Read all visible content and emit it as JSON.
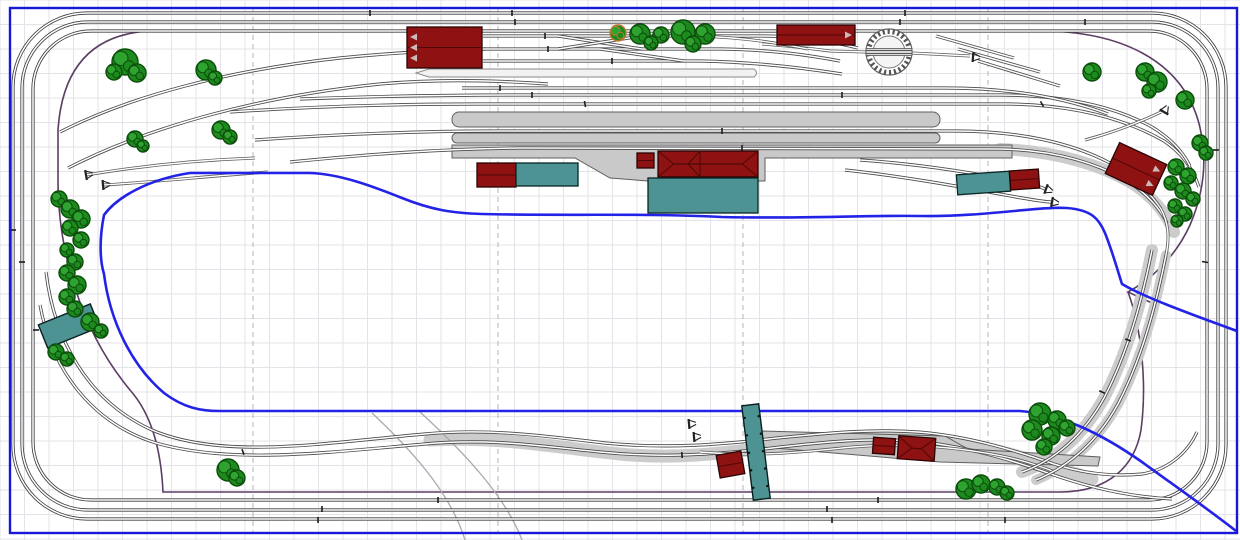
{
  "canvas": {
    "w": 1240,
    "h": 540,
    "bg": "#ffffff"
  },
  "grid": {
    "spacing": 24.5,
    "color": "#e3e3e9",
    "joint_xs": [
      253,
      498,
      743,
      988
    ],
    "joint_color": "#b3b3bc"
  },
  "board": {
    "x": 10,
    "y": 8,
    "w": 1227,
    "h": 525,
    "color": "#1717d8",
    "width": 2.4
  },
  "colors": {
    "ballast": "#cccccc",
    "platform_fill": "#c9c9c9",
    "platform_edge": "#5f5f5f",
    "building_red": "#8e1212",
    "building_red_edge": "#2a0404",
    "roof_line": "#4e0808",
    "building_teal": "#4e9393",
    "building_teal_edge": "#082626",
    "tree_fill": "#1d8a1d",
    "tree_edge": "#0c4d0c",
    "tree_highlight": "#2fa32f",
    "tree_autumn_edge": "#c07830",
    "river": "#2323e8",
    "hidden_line": "#5b3d63",
    "road": "#aaaaaa",
    "arrow_fill": "#cdb8b8",
    "tick": "#1b1b1b",
    "buffer": "#222222"
  },
  "styles": {
    "loop": [
      "#3e3e3e",
      3.2,
      "#ffffff",
      1.5
    ],
    "dark": [
      "#4a4a4a",
      3.2,
      "#ffffff",
      1.5
    ],
    "mid": [
      "#5a5a5a",
      3.0,
      "#ffffff",
      1.4
    ],
    "light": [
      "#8c8c8c",
      2.8,
      "#ffffff",
      1.3
    ]
  },
  "loops": [
    {
      "id": "outer-main-loop",
      "rect": [
        13,
        13,
        1213,
        506,
        74
      ]
    },
    {
      "id": "second-main-loop",
      "rect": [
        22,
        22,
        1196,
        488,
        66
      ]
    },
    {
      "id": "third-loop",
      "rect": [
        33,
        31,
        1174,
        469,
        58
      ]
    }
  ],
  "hidden_line": {
    "id": "hidden-track-loop",
    "d": "M 150,31 L 1040,31 C 1120,31 1180,60 1198,120 C 1208,155 1205,190 1190,225 C 1175,258 1150,280 1128,292 L 1152,303 M 150,31 C 90,34 62,70 58,130 L 58,180 C 58,250 80,330 130,390 C 152,415 161,450 163,492 L 1060,492 C 1110,492 1135,465 1141,430 C 1147,385 1142,330 1128,292",
    "width": 1.6
  },
  "ballast": [
    {
      "d": "M 430,440 C 500,436 560,448 620,454 C 680,460 730,452 790,445 C 850,438 890,436 940,440 C 990,446 1042,463 1092,479",
      "w": 13
    },
    {
      "d": "M 1152,250 C 1142,300 1128,352 1104,398 C 1084,434 1056,460 1022,472",
      "w": 12
    },
    {
      "d": "M 1166,255 C 1156,305 1142,358 1118,404 C 1098,440 1070,466 1036,480",
      "w": 10
    },
    {
      "d": "M 1000,149 C 1052,151 1096,163 1130,182 C 1152,196 1166,212 1174,232",
      "w": 12
    }
  ],
  "tracks": [
    {
      "id": "lead-west-upper",
      "style": "dark",
      "d": "M 60,132 C 130,96 230,70 340,58 C 390,53 440,50 486,49"
    },
    {
      "id": "lead-west-mid",
      "style": "dark",
      "d": "M 68,168 C 150,126 262,96 380,84 C 434,79 492,80 548,84"
    },
    {
      "id": "approach-west-1",
      "style": "dark",
      "d": "M 230,112 C 320,106 400,104 480,104 L 1010,104 C 1070,105 1122,117 1164,141 C 1182,153 1193,169 1199,187"
    },
    {
      "id": "approach-west-2",
      "style": "dark",
      "d": "M 300,99 C 380,96 452,95 520,95 L 1000,95 C 1060,95 1112,105 1152,127 C 1170,138 1183,152 1190,166"
    },
    {
      "id": "yard-low",
      "style": "dark",
      "d": "M 462,88 L 945,88 C 1010,88 1062,97 1108,114"
    },
    {
      "id": "station-track-s1",
      "style": "dark",
      "d": "M 255,140 C 340,134 420,131 500,131 L 955,131 C 1020,131 1072,143 1110,163 C 1132,175 1149,191 1161,209"
    },
    {
      "id": "station-track-s2",
      "style": "dark",
      "d": "M 290,162 C 370,154 440,149 520,148 L 1000,149 C 1050,150 1092,161 1126,180 C 1146,193 1159,207 1167,223"
    },
    {
      "id": "goods-siding-1",
      "style": "dark",
      "d": "M 860,160 C 920,164 980,174 1020,182 C 1034,185 1041,187 1045,189"
    },
    {
      "id": "goods-siding-2",
      "style": "dark",
      "d": "M 845,170 C 910,177 972,189 1016,197 C 1034,200 1045,202 1051,202"
    },
    {
      "id": "stub-siding-1",
      "style": "mid",
      "d": "M 255,158 C 200,160 140,166 86,175"
    },
    {
      "id": "stub-siding-2",
      "style": "mid",
      "d": "M 268,172 C 210,176 155,182 103,185"
    },
    {
      "id": "shed-track-1",
      "style": "dark",
      "d": "M 483,36 L 758,36 C 802,36 830,41 858,48"
    },
    {
      "id": "shed-track-2",
      "style": "dark",
      "d": "M 483,49 L 722,49 C 774,50 808,55 840,61"
    },
    {
      "id": "shed-track-3",
      "style": "dark",
      "d": "M 483,61 L 700,61 C 754,62 798,67 842,74"
    },
    {
      "id": "turntable-feed-west",
      "style": "mid",
      "d": "M 762,44 C 792,46 814,49 830,51 L 866,52"
    },
    {
      "id": "turntable-feed-east",
      "style": "mid",
      "d": "M 912,53 L 970,56"
    },
    {
      "id": "crossover-1a",
      "style": "dark",
      "d": "M 558,36 L 642,49"
    },
    {
      "id": "crossover-1b",
      "style": "dark",
      "d": "M 642,36 L 558,49"
    },
    {
      "id": "crossover-2",
      "style": "dark",
      "d": "M 600,49 L 684,61"
    },
    {
      "id": "ladder-1",
      "style": "dark",
      "d": "M 936,36 L 1014,58"
    },
    {
      "id": "ladder-2",
      "style": "dark",
      "d": "M 958,49 L 1040,72"
    },
    {
      "id": "ladder-3",
      "style": "dark",
      "d": "M 978,61 L 1060,86"
    },
    {
      "id": "top-link",
      "style": "mid",
      "d": "M 700,36 C 748,38 778,43 808,49"
    },
    {
      "id": "branch-south-a",
      "style": "dark",
      "d": "M 40,305 C 52,372 94,424 156,443 C 232,465 330,452 425,444 C 490,438 540,446 600,452 C 660,458 712,455 772,448 C 832,441 868,438 912,441 C 962,445 1008,459 1048,473 C 1090,488 1132,497 1172,499"
    },
    {
      "id": "branch-south-b",
      "style": "dark",
      "d": "M 46,272 C 54,338 86,400 152,430 C 224,461 330,442 425,434 C 490,428 545,436 605,443 C 665,449 717,445 777,438 C 837,432 874,429 918,432 C 968,436 1014,450 1054,464 C 1082,473 1112,477 1142,474 C 1167,470 1187,454 1197,432"
    },
    {
      "id": "goods-loop",
      "style": "mid",
      "d": "M 700,452 C 762,457 802,452 852,447 C 902,443 952,446 1002,456 C 1022,460 1040,466 1055,472"
    },
    {
      "id": "diagonal-1",
      "style": "dark",
      "d": "M 1152,250 C 1142,300 1128,352 1104,398 C 1084,434 1056,460 1022,472"
    },
    {
      "id": "diagonal-2",
      "style": "dark",
      "d": "M 1166,255 C 1156,305 1142,358 1118,404 C 1098,440 1070,466 1036,480"
    },
    {
      "id": "se-curve-link",
      "style": "mid",
      "d": "M 1161,209 C 1168,222 1170,236 1166,255"
    },
    {
      "id": "ne-stub",
      "style": "mid",
      "d": "M 1085,140 C 1115,132 1140,122 1161,112"
    }
  ],
  "river": {
    "id": "river",
    "d": "M 190,173 L 310,173 C 340,174 372,186 402,198 C 432,210 452,213 482,214 C 562,216 642,213 722,217 C 802,219 862,215 922,216 C 982,217 1042,206 1067,208 C 1092,210 1099,219 1105,233 C 1113,253 1118,272 1122,284 C 1142,296 1182,311 1237,331 M 190,173 C 150,179 118,196 104,215 C 99,240 100,261 104,274 C 110,322 132,366 164,393 C 184,408 201,411 219,411 L 1020,411 C 1062,414 1102,434 1142,462 C 1182,491 1212,512 1236,531",
    "width": 2.6
  },
  "roads": [
    {
      "id": "road-1",
      "d": "M 372,413 C 420,458 452,498 465,540"
    },
    {
      "id": "road-2",
      "d": "M 420,412 C 468,456 506,498 522,540"
    }
  ],
  "platforms": [
    {
      "id": "platform-1",
      "x": 452,
      "y": 112,
      "w": 488,
      "h": 15,
      "rx": 7
    },
    {
      "id": "platform-2",
      "x": 452,
      "y": 133,
      "w": 488,
      "h": 10,
      "rx": 5
    }
  ],
  "aprons": [
    {
      "id": "station-forecourt",
      "points": "452,145 1012,145 1012,158 765,158 765,181 648,181 610,178 575,158 452,158"
    },
    {
      "id": "goods-platform",
      "points": "762,431 945,436 968,449 1100,457 1098,466 940,462 762,447"
    }
  ],
  "arrow_track": {
    "id": "uncoupler-track",
    "d": "M 429,69 L 754,69 Q 759,73 754,77 L 429,77 L 416,73 Z"
  },
  "turntable": {
    "id": "turntable",
    "cx": 889,
    "cy": 52,
    "r": 23
  },
  "buildings": [
    {
      "id": "engine-shed",
      "x": 407,
      "y": 27,
      "w": 75,
      "h": 41,
      "rot": 0,
      "color": "red",
      "roof": "midline",
      "arrows": {
        "side": "left",
        "ys": [
          10,
          20.5,
          31
        ]
      }
    },
    {
      "id": "depot-shed",
      "x": 777,
      "y": 25,
      "w": 78,
      "h": 20,
      "rot": 0,
      "color": "red",
      "roof": "midline",
      "arrows": {
        "side": "right",
        "ys": [
          10
        ]
      }
    },
    {
      "id": "station-annex-red",
      "x": 477,
      "y": 163,
      "w": 39,
      "h": 24,
      "rot": 0,
      "color": "red",
      "roof": "midline"
    },
    {
      "id": "station-annex-teal",
      "x": 516,
      "y": 163,
      "w": 62,
      "h": 23,
      "rot": 0,
      "color": "teal",
      "roof": "flat"
    },
    {
      "id": "small-shed",
      "x": 637,
      "y": 153,
      "w": 17,
      "h": 15,
      "rot": 0,
      "color": "red",
      "roof": "midline"
    },
    {
      "id": "station-main",
      "x": 658,
      "y": 151,
      "w": 100,
      "h": 26,
      "rot": 0,
      "color": "red",
      "roof": "hip2"
    },
    {
      "id": "station-hall",
      "x": 648,
      "y": 178,
      "w": 110,
      "h": 35,
      "rot": 0,
      "color": "teal",
      "roof": "flat"
    },
    {
      "id": "goods-shed-teal",
      "x": 957,
      "y": 173,
      "w": 53,
      "h": 20,
      "rot": -4,
      "color": "teal",
      "roof": "flat"
    },
    {
      "id": "goods-shed-red",
      "x": 1010,
      "y": 170,
      "w": 29,
      "h": 19,
      "rot": -4,
      "color": "red",
      "roof": "midline"
    },
    {
      "id": "warehouse-ne",
      "x": 1110,
      "y": 152,
      "w": 52,
      "h": 34,
      "rot": 25,
      "color": "red",
      "roof": "midline",
      "arrows": {
        "side": "right",
        "ys": [
          9,
          25
        ]
      }
    },
    {
      "id": "lineside-hut",
      "x": 718,
      "y": 453,
      "w": 25,
      "h": 23,
      "rot": -10,
      "color": "red",
      "roof": "midline"
    },
    {
      "id": "goods-hut-small",
      "x": 873,
      "y": 438,
      "w": 22,
      "h": 16,
      "rot": 4,
      "color": "red",
      "roof": "midline"
    },
    {
      "id": "goods-hut-big",
      "x": 898,
      "y": 437,
      "w": 37,
      "h": 23,
      "rot": 4,
      "color": "red",
      "roof": "hip"
    }
  ],
  "bridges": [
    {
      "id": "river-bridge",
      "cx": 69,
      "cy": 326,
      "w": 56,
      "h": 25,
      "rot": -22,
      "dots": false
    },
    {
      "id": "road-bridge",
      "cx": 756,
      "cy": 452,
      "w": 17,
      "h": 95,
      "rot": -7,
      "dots": true
    }
  ],
  "buffers": [
    [
      86,
      175,
      -10
    ],
    [
      103,
      185,
      -5
    ],
    [
      1046,
      189,
      20
    ],
    [
      1052,
      202,
      10
    ],
    [
      1164,
      112,
      -60
    ],
    [
      973,
      57,
      5
    ],
    [
      689,
      424,
      -5
    ],
    [
      694,
      437,
      -5
    ]
  ],
  "ticks": [
    [
      370,
      13,
      90
    ],
    [
      512,
      13,
      90
    ],
    [
      905,
      13,
      90
    ],
    [
      515,
      22,
      90
    ],
    [
      900,
      22,
      90
    ],
    [
      1085,
      22,
      90
    ],
    [
      545,
      36,
      90
    ],
    [
      548,
      49,
      90
    ],
    [
      612,
      61,
      90
    ],
    [
      500,
      88,
      90
    ],
    [
      532,
      95,
      90
    ],
    [
      585,
      104,
      80
    ],
    [
      722,
      131,
      90
    ],
    [
      742,
      148,
      90
    ],
    [
      842,
      95,
      90
    ],
    [
      1042,
      104,
      60
    ],
    [
      13,
      230,
      0
    ],
    [
      22,
      262,
      0
    ],
    [
      36,
      330,
      0
    ],
    [
      318,
      520,
      90
    ],
    [
      322,
      509,
      90
    ],
    [
      438,
      500,
      90
    ],
    [
      832,
      520,
      90
    ],
    [
      827,
      509,
      90
    ],
    [
      878,
      500,
      90
    ],
    [
      1005,
      520,
      90
    ],
    [
      243,
      452,
      70
    ],
    [
      682,
      455,
      85
    ],
    [
      908,
      439,
      85
    ],
    [
      1128,
      340,
      20
    ],
    [
      1102,
      392,
      25
    ],
    [
      1216,
      150,
      0
    ],
    [
      1205,
      262,
      10
    ]
  ],
  "trees": [
    [
      125,
      62,
      13
    ],
    [
      137,
      73,
      9
    ],
    [
      114,
      72,
      8
    ],
    [
      206,
      70,
      10
    ],
    [
      215,
      78,
      7
    ],
    [
      135,
      139,
      8
    ],
    [
      143,
      146,
      6
    ],
    [
      221,
      130,
      9
    ],
    [
      230,
      137,
      7
    ],
    [
      59,
      199,
      8
    ],
    [
      70,
      209,
      9
    ],
    [
      81,
      219,
      9
    ],
    [
      70,
      228,
      8
    ],
    [
      81,
      240,
      8
    ],
    [
      67,
      250,
      7
    ],
    [
      75,
      262,
      8
    ],
    [
      67,
      273,
      8
    ],
    [
      77,
      285,
      9
    ],
    [
      67,
      297,
      8
    ],
    [
      75,
      309,
      8
    ],
    [
      90,
      322,
      9
    ],
    [
      101,
      331,
      7
    ],
    [
      56,
      352,
      8
    ],
    [
      67,
      359,
      7
    ],
    [
      228,
      470,
      11
    ],
    [
      237,
      478,
      8
    ],
    [
      618,
      33,
      8,
      1
    ],
    [
      640,
      34,
      10
    ],
    [
      661,
      35,
      8
    ],
    [
      683,
      32,
      12
    ],
    [
      705,
      34,
      10
    ],
    [
      651,
      43,
      7
    ],
    [
      693,
      44,
      8
    ],
    [
      1092,
      72,
      9
    ],
    [
      1145,
      72,
      9
    ],
    [
      1157,
      82,
      10
    ],
    [
      1149,
      91,
      7
    ],
    [
      1185,
      100,
      9
    ],
    [
      1200,
      143,
      8
    ],
    [
      1206,
      153,
      7
    ],
    [
      1176,
      167,
      8
    ],
    [
      1188,
      176,
      8
    ],
    [
      1171,
      183,
      7
    ],
    [
      1183,
      191,
      8
    ],
    [
      1193,
      199,
      7
    ],
    [
      1175,
      206,
      7
    ],
    [
      1185,
      214,
      7
    ],
    [
      1177,
      221,
      6
    ],
    [
      1040,
      414,
      11
    ],
    [
      1057,
      420,
      9
    ],
    [
      1032,
      430,
      10
    ],
    [
      1051,
      436,
      9
    ],
    [
      1067,
      428,
      8
    ],
    [
      1044,
      447,
      8
    ],
    [
      966,
      489,
      10
    ],
    [
      981,
      484,
      9
    ],
    [
      997,
      487,
      8
    ],
    [
      1007,
      493,
      7
    ]
  ]
}
